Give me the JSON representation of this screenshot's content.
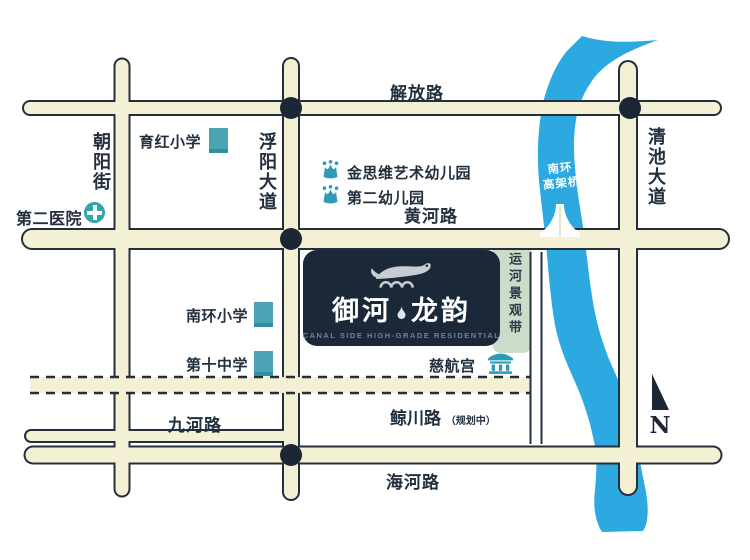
{
  "roads": {
    "jiefang_road": "解放路",
    "huanghe_road": "黄河路",
    "jiuhe_road": "九河路",
    "haihe_road": "海河路",
    "jingchuan_road": "鲸川路",
    "jingchuan_status": "（规划中）",
    "chaoyang_street": "朝阳街",
    "fuyang_avenue": "浮阳大道",
    "qingchi_avenue": "清池大道"
  },
  "pois": {
    "second_hospital": "第二医院",
    "yuhong_primary_school": "育红小学",
    "jinsiwei_art_kindergarten": "金思维艺术幼儿园",
    "no2_kindergarten": "第二幼儿园",
    "nanhuan_primary_school": "南环小学",
    "no10_middle_school": "第十中学",
    "cihang_temple": "慈航宫"
  },
  "river": {
    "bridge_line1": "南环",
    "bridge_line2": "高架桥"
  },
  "belt_label": "运河景观带",
  "logo": {
    "name_left": "御河",
    "name_right": "龙韵",
    "subtitle": "CANAL SIDE HIGH-GRADE RESIDENTIAL"
  },
  "compass_n": "N",
  "colors": {
    "road_fill": "#f4f0d3",
    "outline_navy": "#232f3d",
    "river_blue": "#2ca9e1",
    "belt_green": "#ccdcc8",
    "poi_teal": "#3d9fb0",
    "logo_bg": "#1b2838"
  }
}
